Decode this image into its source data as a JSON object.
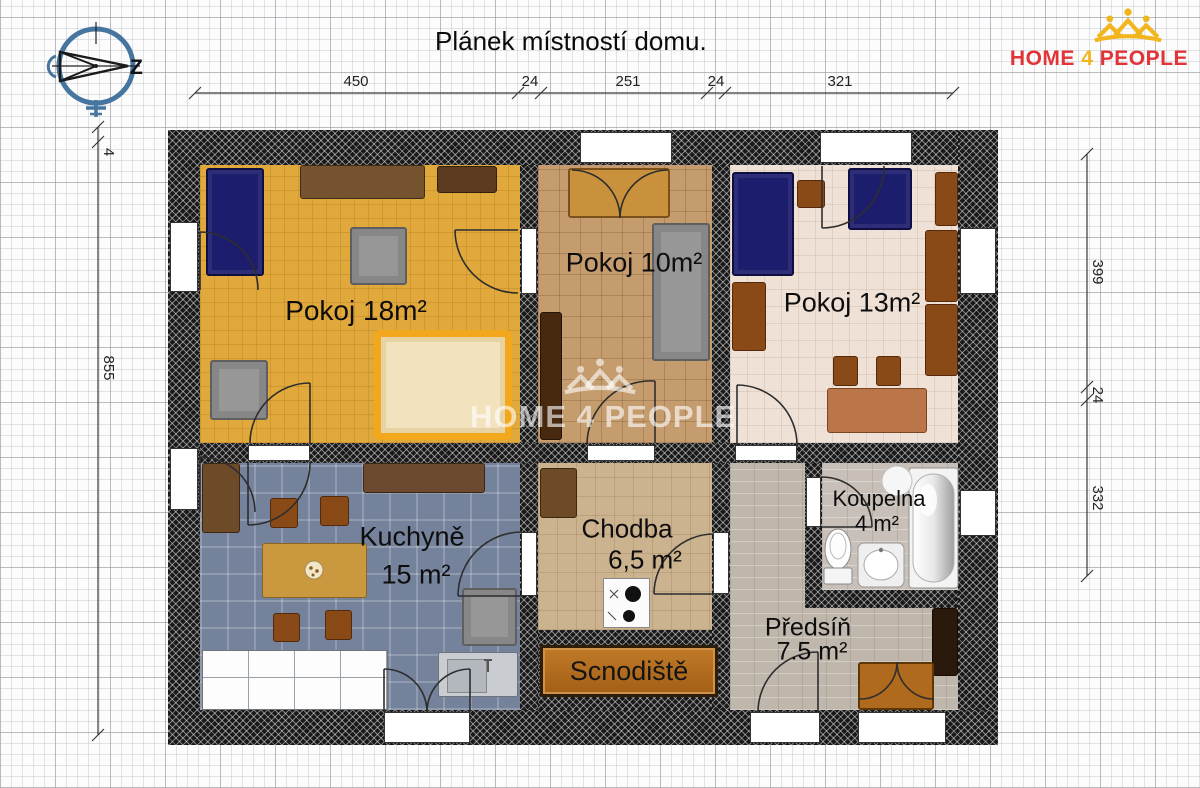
{
  "title": "Plánek místností domu.",
  "logo": {
    "home": "HOME",
    "four": "4",
    "people": "PEOPLE"
  },
  "watermark": {
    "text": "HOME 4 PEOPLE"
  },
  "compass": {
    "west": "Z"
  },
  "dimensions": {
    "top": [
      "450",
      "24",
      "251",
      "24",
      "321"
    ],
    "left": [
      "4",
      "855"
    ],
    "right": [
      "399",
      "24",
      "332"
    ]
  },
  "rooms": {
    "pokoj18": {
      "label": "Pokoj 18m²"
    },
    "pokoj10": {
      "label": "Pokoj 10m²"
    },
    "pokoj13": {
      "label": "Pokoj 13m²"
    },
    "kuchyne": {
      "label": "Kuchyně",
      "area": "15 m²"
    },
    "chodba": {
      "label": "Chodba",
      "area": "6,5 m²"
    },
    "koupelna": {
      "label": "Koupelna",
      "area": "4 m²"
    },
    "predsin": {
      "label": "Předsíň",
      "area": "7.5 m²"
    }
  },
  "staircase": {
    "label": "Scnodiště"
  },
  "colors": {
    "brand_red": "#e23438",
    "brand_yellow": "#f2b51d",
    "compass_blue": "#46759f",
    "floor_pokoj18": "#e1a83c",
    "floor_pokoj10": "#c59c6e",
    "floor_pokoj13": "#efe1d6",
    "floor_kuchyne": "#74829b",
    "floor_chodba": "#ccb38f",
    "floor_koupelna": "#c8c0b8",
    "floor_predsin": "#bfb7ac",
    "wall": "#191919",
    "staircase_fill": "#a35f16"
  }
}
